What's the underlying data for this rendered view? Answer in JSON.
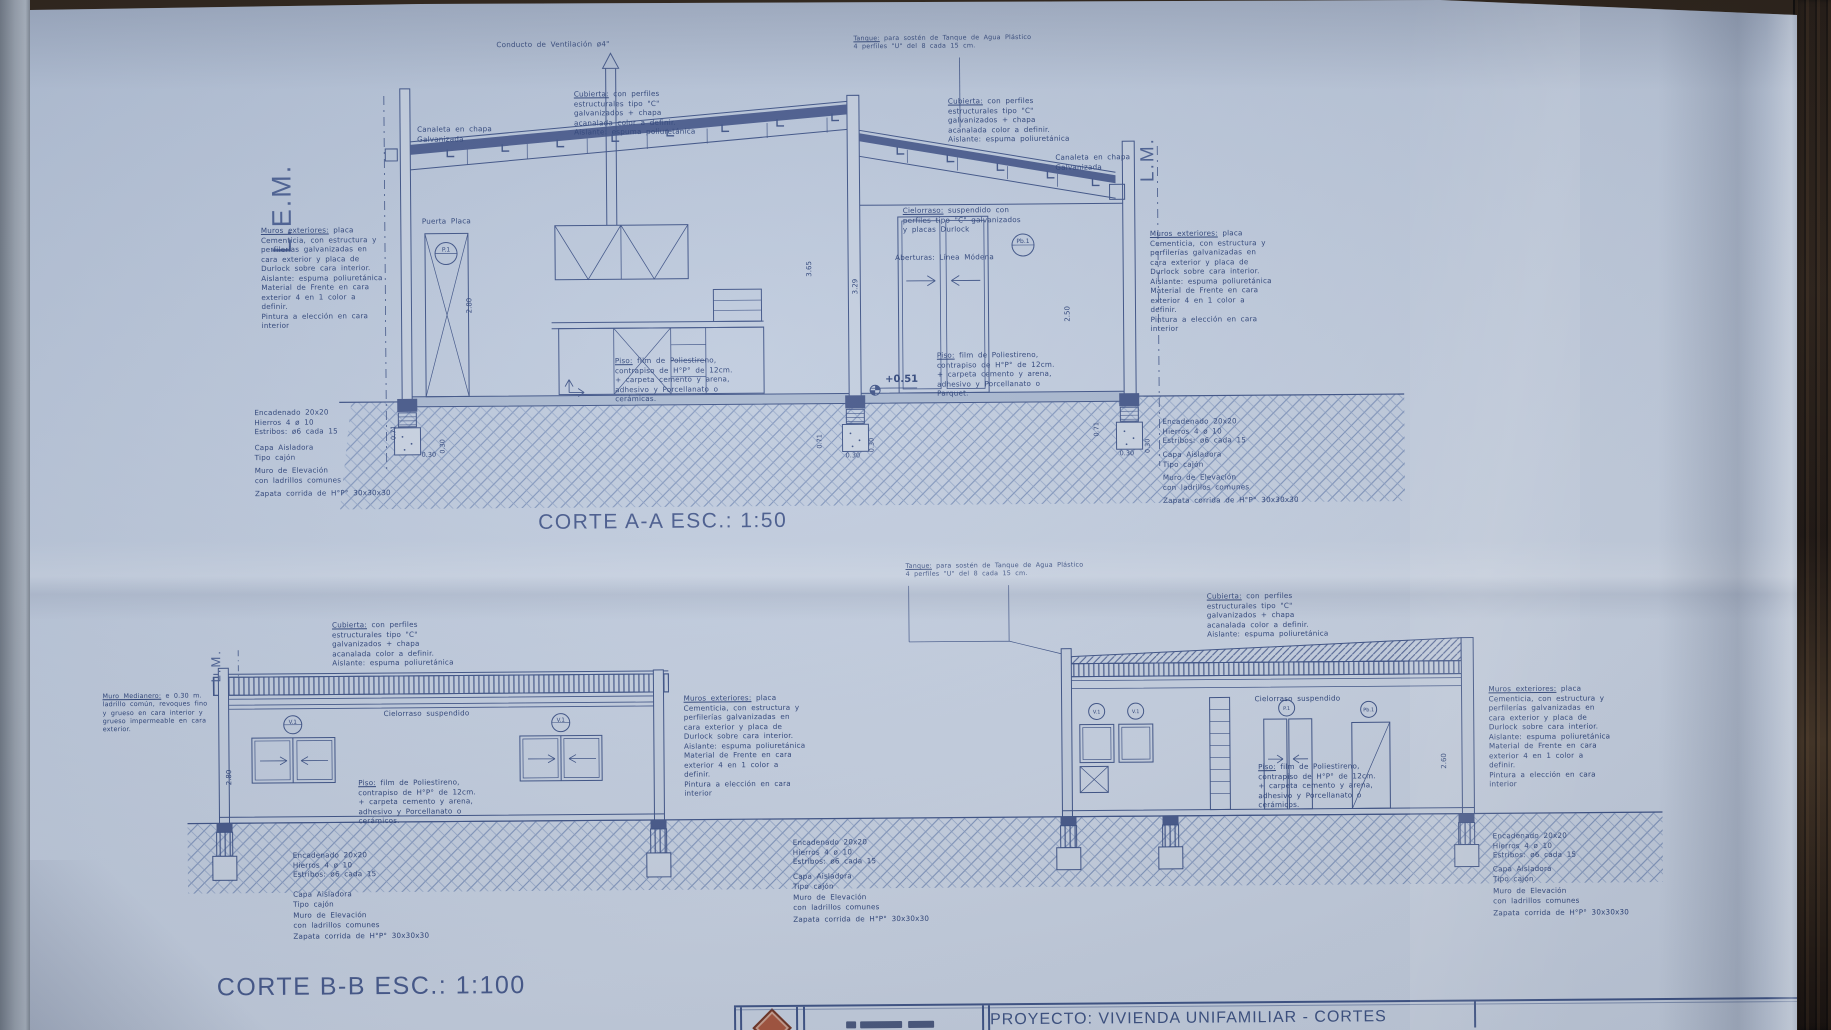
{
  "colors": {
    "ink": "#3d5286",
    "text": "#2d4379",
    "title": "#46598c",
    "paper": "#bfcbdd",
    "wood": "#2a1f15",
    "logo": "#a8553c"
  },
  "corte_a": {
    "title": "CORTE A-A ESC.: 1:50"
  },
  "corte_b": {
    "title": "CORTE B-B ESC.: 1:100"
  },
  "ann": {
    "lem": "L.E.M.",
    "lm": "L.M.",
    "conducto": "Conducto de Ventilación ø4\"",
    "tanque": {
      "t": "Tanque:",
      "b": "para sostén de Tanque de Agua Plástico\n4 perfiles \"U\" del 8 cada 15 cm."
    },
    "cubierta": {
      "t": "Cubierta:",
      "b": "con perfiles\nestructurales tipo \"C\"\ngalvanizados + chapa\nacanalada color a definir.\nAislante: espuma poliuretánica"
    },
    "canaleta": "Canaleta en chapa\nGalvanizada",
    "muros": {
      "t": "Muros exteriores:",
      "b": "placa\nCementicia, con estructura y\nperfilerías galvanizadas en\ncara exterior y placa de\nDurlock sobre cara interior.\nAislante: espuma poliuretánica\nMaterial de Frente en cara\nexterior 4 en 1 color a\ndefinir.\nPintura a elección en cara\ninterior"
    },
    "cielorraso_a": {
      "t": "Cielorraso:",
      "b": "suspendido con\nperfiles tipo \"C\" galvanizados\ny placas Durlock"
    },
    "cielorraso_b": "Cielorraso suspendido",
    "puerta": "Puerta Placa",
    "aberturas": "Aberturas: Línea Módena",
    "piso_ceramicas": {
      "t": "Piso:",
      "b": "film de Poliestireno,\ncontrapiso de H°P° de 12cm.\n+ carpeta cemento y arena,\nadhesivo y Porcellanato o\ncerámicas."
    },
    "piso_parquet": {
      "t": "Piso:",
      "b": "film de Poliestireno,\ncontrapiso de H°P° de 12cm.\n+ carpeta cemento y arena,\nadhesivo y Porcellanato o\nParquet."
    },
    "piso_ceramicos": {
      "t": "Piso:",
      "b": "film de Poliestireno,\ncontrapiso de H°P° de 12cm.\n+ carpeta cemento y arena,\nadhesivo y Porcellanato o\ncerámicos."
    },
    "medianero": {
      "t": "Muro Medianero:",
      "b": "e 0.30 m.\nladrillo común, revoques fino\ny grueso en cara interior y\ngrueso impermeable en cara\nexterior."
    },
    "encadenado": "Encadenado 20x20\nHierros 4 ø 10\nEstribos: ø6 cada 15",
    "capa": "Capa Aisladora\nTipo cajón",
    "muro_elev": "Muro de Elevación\ncon ladrillos comunes",
    "zapata": "Zapata corrida de H°P° 30x30x30"
  },
  "dims": {
    "h280": "2.80",
    "h365": "3.65",
    "h329": "3.29",
    "h250": "2.50",
    "h260": "2.60",
    "n051": "+0.51",
    "d071": "0.71",
    "d030": "0.30"
  },
  "symbols": {
    "p1": "P.1",
    "pb1": "Pb.1",
    "v1": "V.1"
  },
  "titleblock": {
    "proyecto": "PROYECTO: VIVIENDA UNIFAMILIAR - CORTES"
  }
}
